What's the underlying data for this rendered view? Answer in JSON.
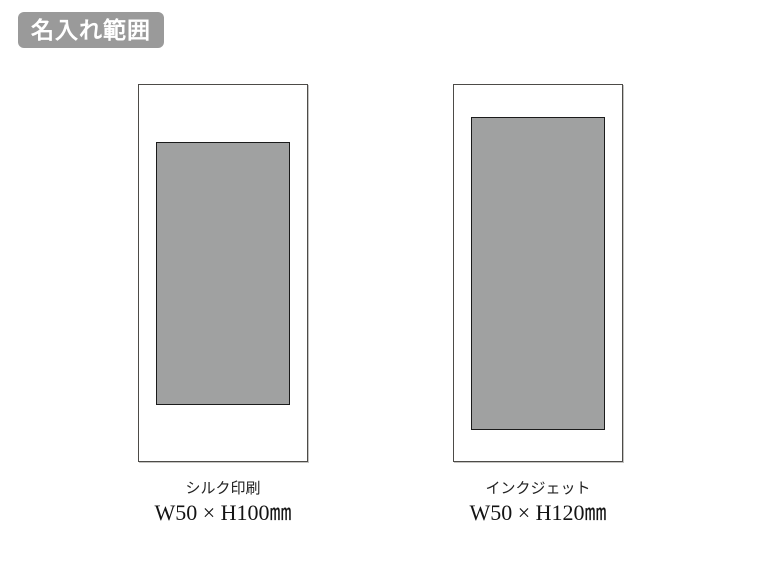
{
  "badge": {
    "label": "名入れ範囲",
    "bg_color": "#9a9a9a",
    "text_color": "#ffffff"
  },
  "figures": [
    {
      "method": "シルク印刷",
      "size": "W50 × H100㎜",
      "area_color": "#a0a1a1",
      "outline_color": "#4d4b48"
    },
    {
      "method": "インクジェット",
      "size": "W50 × H120㎜",
      "area_color": "#a0a1a1",
      "outline_color": "#4d4b48"
    }
  ]
}
